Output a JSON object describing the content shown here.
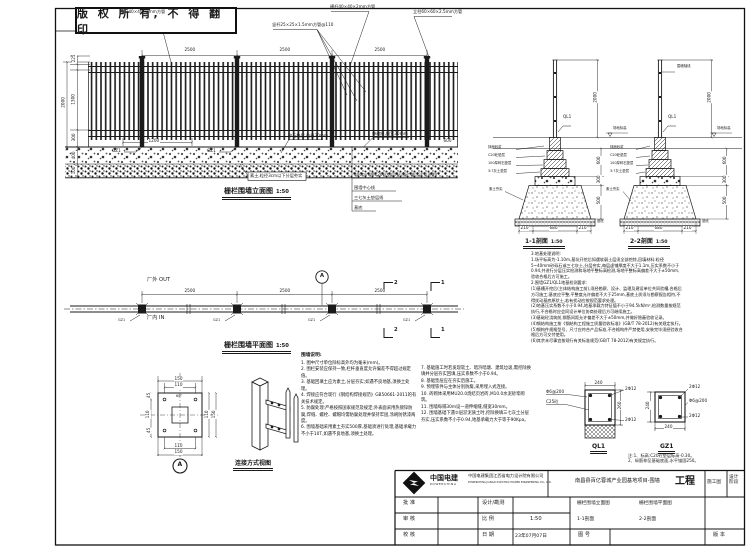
{
  "page": {
    "stamp": "版 权 所 有, 不 得 翻 印"
  },
  "elevation": {
    "title": "栅栏围墙立面图",
    "scale": "1:50",
    "bay_dim": "2500",
    "callout_rail_top": "横杆40×40×2mm方管",
    "callout_rail_mid": "横杆40×40×2mm方管",
    "callout_picket": "竖杆25×25×1.5mm方管@110",
    "callout_post": "立柱60×60×2.5mm方管",
    "callout_gravel": "碎石垫层,粒径30mm",
    "callout_joint": "伸缩缝,缝宽30mm",
    "callout_soil": "素土,粒径3cm以下分层夯实",
    "base_callouts": [
      "300mm厚C20砼垫层(抗渗砼,做法详见说明)",
      "围墙中心线",
      "三七灰土垫层线",
      "基底"
    ],
    "dim_225": "225",
    "dim_1300": "1300",
    "dim_300": "300",
    "dim_2000": "2000",
    "dim_400": "400",
    "dim_100": "100",
    "dim_1200": "1200",
    "dim_600": "600",
    "gz_label": "GZ1"
  },
  "sections": {
    "s1_title": "1-1剖面",
    "s2_title": "2-2剖面",
    "scale": "1:50",
    "ql_label": "QL1",
    "ground_label": "场地标高",
    "axis_label": "围墙轴线",
    "callouts": [
      "抹面砂浆",
      "C20砼垫层",
      "100厚碎石垫层",
      "3:7灰土垫层"
    ],
    "pit_label": "素土夯实",
    "base_label": "基底",
    "dim_2000": "2000",
    "dim_600": "600",
    "dim_300": "300",
    "dim_500": "500",
    "dim_210": "210",
    "dim_680": "680"
  },
  "plan": {
    "title": "栅栏围墙平面图",
    "scale": "1:50",
    "out_label": "厂外 OUT",
    "in_label": "厂内 IN",
    "bay_dim": "2500",
    "gz_label": "GZ1",
    "detail_mark": "A",
    "mark_1": "1",
    "mark_2": "2"
  },
  "detailA": {
    "mark": "A",
    "dim_150": "150",
    "dim_110": "110",
    "dim_45": "45",
    "dim_60": "60°"
  },
  "connection": {
    "title": "连接方式视图"
  },
  "notes": {
    "title": "围墙说明:",
    "left": "1. 图中尺寸单位除标高外均为毫米(mm)。\n2. 围栏安装应保持一致,栏杆垂直度允许偏差不得超过规定值。\n3. 基础回填土应为素土,分层夯实;如遇不良地基,须换土处理。\n4. 焊接应符合现行《钢结构焊接规范》GB50661-2011的有关技术规定。\n5. 防腐处理:严格按照国家规范及规定;外表面采用热镀锌防腐,焊缝、螺栓、螺帽均需防腐处理并保持牢固,涂刷防锈漆两度。\n6. 围墙基础采用素土夯实500厚,基础须进行处理,基础承载力不小于10T,如遇不良地基,须换土处理。",
    "right": "7. 基础施工时若发现软土、暗浜暗塘、建筑垃圾,需挖除换填并分层夯实回填,压实系数不小于0.94。\n8. 基础垫层应在夯实后施工。\n9. 预埋铁件与主体分别防腐,采用埋入式连接。\n10. 砖砌体采用MU20.0烧结页岩砖,M10.0水泥砂浆砌筑。\n11. 围墙每隔30m设一道伸缩缝,缝宽30mm。\n12. 围墙基础下遇②层淤泥质土时,挖除换填三七灰土分层夯实,压实系数不小于0.94,地基承载力大于等于90Kpa。"
  },
  "geo_notes": {
    "text": "3.地基处理说明:\n1.场平标高为-1.10m,基坑开挖后如遇软弱土层须全部挖除,回填材料:粒径5~40mm砂砾石或三七灰土,分层夯实,每层虚铺厚度不大于1.1m,压实系数不小于0.94,并进行分层压实检测和场地平整标高检测,场地平整标高偏差不大于±50mm,验收合格后方可施工。\n2.围墙GZ1/QL1地基检测要求:\n(1)基槽开挖后(主体结构施工前),须经勘察、设计、监理及建设单位共同验槽,合格后方可施工;基底应平整,平整度允许偏差不大于25mm,基底土质须与勘察报告相符,不得扰动基底原状土,若有扰动应按规范要求处理。\n(2)地基压实系数不小于0.94,地基承载力特征值不小于94.5kN/m²,检测数量按规范执行,不合格时应会同设计单位协商处理后方可继续施工。\n(3)基础砼浇筑前,钢筋间距允许偏差不大于±50mm,并做好隐蔽验收记录。\n(4)钢结构施工按《钢结构工程施工质量验收标准》(GB/T 78-2012)有关规定执行。\n(5)钢构件规格型号、尺寸应符合产品标准,不合格构件严禁使用,安装完毕须经验收合格后方可交付使用。\n(6)其余未尽事宜按现行有关标准规范(GB/T 78-2012)有关规定执行。"
  },
  "rebar": {
    "ql1_title": "QL1",
    "gz1_title": "GZ1",
    "bar2d12": "2Φ12",
    "stirrup": "Φ6@200",
    "conc": "C25砼",
    "dim_240": "240",
    "dim_260": "260",
    "note": "注:1、标高:C20砼垫层标高-0.30。\n2、纵筋伸至基础底面,水平锚固250。"
  },
  "titleblock": {
    "brand": "中国电建",
    "brand_en": "POWERCHINA",
    "company": "中国电建集团江西省电力设计院有限公司",
    "company_en": "POWERCHINA JIANGXI ELECTRIC POWER ENGINEERING CO., LTD.",
    "project": "南昌县百亿蓉城产业园基地项目-围墙",
    "project_type": "工程",
    "stage_tag": "施工图",
    "stage_label": "设计阶段",
    "row_approve": "批 准",
    "row_review": "审 核",
    "row_check": "校 核",
    "col_design": "设计/勘测",
    "col_scale": "比 例",
    "col_date": "日 期",
    "scale_value": "1:50",
    "date_value": "23年07月07日",
    "dwg1": "栅栏围墙立面图",
    "dwg2": "栅栏围墙平面图",
    "dwg3": "1-1剖面",
    "dwg4": "2-2剖面",
    "dwg_no_label": "图 号",
    "version_label": "版 本"
  }
}
